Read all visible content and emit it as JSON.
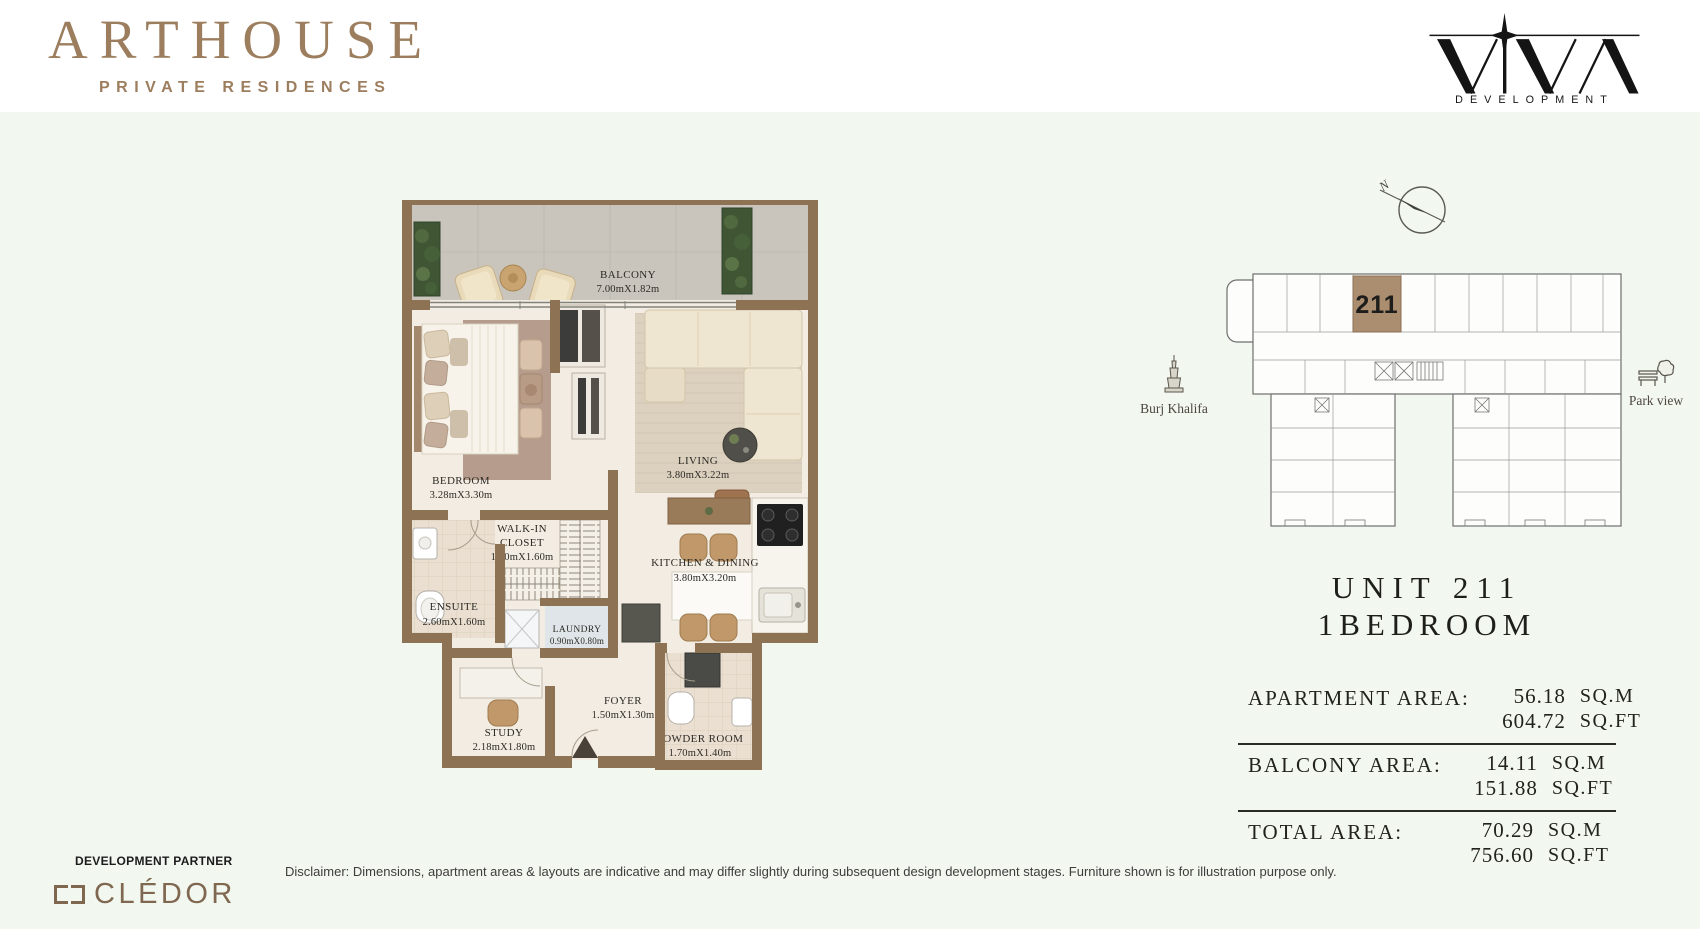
{
  "brand": {
    "name": "ARTHOUSE",
    "tagline": "PRIVATE RESIDENCES",
    "developer_word": "DEVELOPMENT"
  },
  "compass": {
    "north": "N"
  },
  "keyplan": {
    "unit": "211",
    "landmark_left": "Burj Khalifa",
    "landmark_right": "Park view"
  },
  "unit": {
    "line1": "UNIT 211",
    "line2": "1BEDROOM"
  },
  "areas": {
    "rows": [
      {
        "label": "APARTMENT AREA:",
        "sqm": "56.18",
        "sqm_unit": "SQ.M",
        "sqft": "604.72",
        "sqft_unit": "SQ.FT"
      },
      {
        "label": "BALCONY AREA:",
        "sqm": "14.11",
        "sqm_unit": "SQ.M",
        "sqft": "151.88",
        "sqft_unit": "SQ.FT"
      },
      {
        "label": "TOTAL AREA:",
        "sqm": "70.29",
        "sqm_unit": "SQ.M",
        "sqft": "756.60",
        "sqft_unit": "SQ.FT"
      }
    ]
  },
  "floorplan": {
    "rooms": [
      {
        "name": "BALCONY",
        "dims": "7.00mX1.82m"
      },
      {
        "name": "BEDROOM",
        "dims": "3.28mX3.30m"
      },
      {
        "name": "LIVING",
        "dims": "3.80mX3.22m"
      },
      {
        "name": "WALK-IN",
        "name2": "CLOSET",
        "dims": "1.60mX1.60m"
      },
      {
        "name": "ENSUITE",
        "dims": "2.60mX1.60m"
      },
      {
        "name": "LAUNDRY",
        "dims": "0.90mX0.80m"
      },
      {
        "name": "KITCHEN  &  DINING",
        "dims": "3.80mX3.20m"
      },
      {
        "name": "STUDY",
        "dims": "2.18mX1.80m"
      },
      {
        "name": "FOYER",
        "dims": "1.50mX1.30m"
      },
      {
        "name": "POWDER  ROOM",
        "dims": "1.70mX1.40m"
      }
    ]
  },
  "footer": {
    "partner_label": "DEVELOPMENT PARTNER",
    "partner_name": "CLÉDOR",
    "disclaimer": "Disclaimer: Dimensions, apartment areas & layouts are indicative and may differ slightly during subsequent design development stages. Furniture shown is for illustration purpose only."
  },
  "colors": {
    "brand_brown": "#9c7e5e",
    "wall_brown": "#8e7254",
    "background": "#f2f7f0",
    "unit_highlight": "#ab8d6f",
    "ink": "#1e1e1a"
  }
}
